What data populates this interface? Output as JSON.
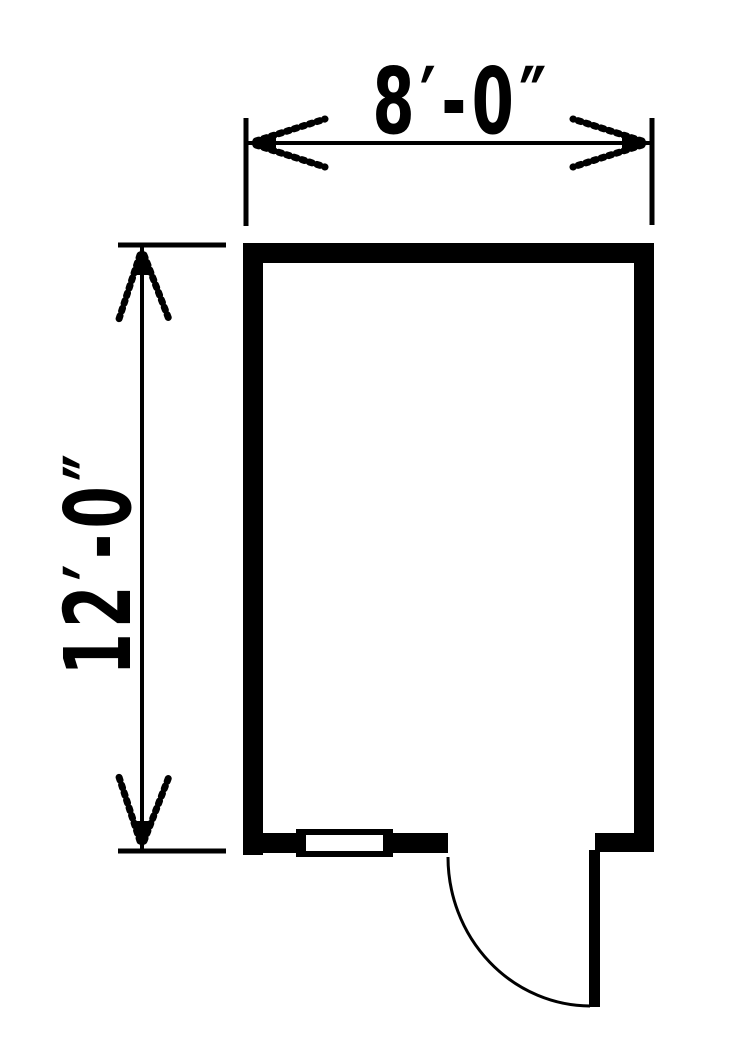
{
  "colors": {
    "line": "#000000",
    "background": "#ffffff"
  },
  "floor_plan": {
    "width_dimension_label": "8′-0″",
    "height_dimension_label": "12′-0″"
  }
}
